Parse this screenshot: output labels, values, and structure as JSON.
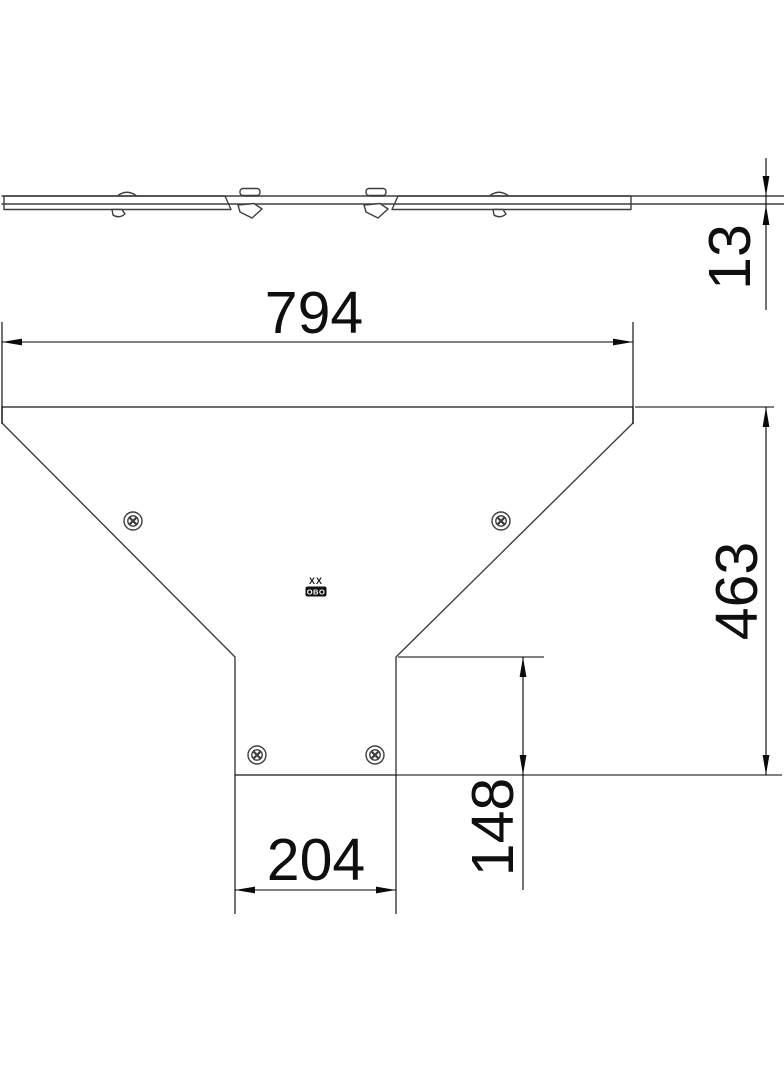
{
  "drawing": {
    "background_color": "#ffffff",
    "line_color": "#3f3f3f",
    "dim_color": "#000000",
    "dims": {
      "top_width": "794",
      "overall_height": "463",
      "neck_width": "204",
      "neck_height": "148",
      "thickness": "13"
    },
    "stamp": {
      "top": "XX",
      "box": "OBO"
    }
  }
}
